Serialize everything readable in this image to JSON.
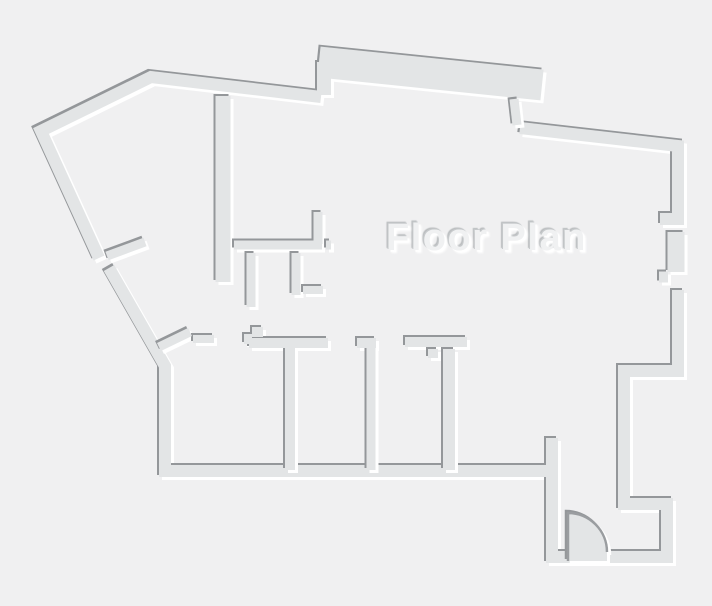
{
  "title": "Floor Plan",
  "colors": {
    "background": "#f0f0f1",
    "wall_fill": "#e3e5e6",
    "edge_dark": "#94979a",
    "edge_highlight": "#ffffff",
    "door_line": "#9a9da0",
    "title_fill": "#f0f1f2"
  },
  "floorplan": {
    "canvas": {
      "width": 712,
      "height": 606
    },
    "exterior": [
      {
        "name": "wall-outline-upper-left",
        "w": 12,
        "points": [
          [
            321,
            97
          ],
          [
            151,
            77
          ],
          [
            41,
            131
          ],
          [
            99,
            258
          ]
        ]
      },
      {
        "name": "wall-outline-lower-left",
        "w": 12,
        "points": [
          [
            109,
            268
          ],
          [
            165,
            366
          ],
          [
            165,
            471
          ],
          [
            548,
            471
          ]
        ]
      },
      {
        "name": "wall-top-protrusion",
        "w": 31,
        "points": [
          [
            319,
            62
          ],
          [
            542,
            85
          ]
        ]
      },
      {
        "name": "wall-protrusion-left-bridge",
        "w": 14,
        "points": [
          [
            324,
            62
          ],
          [
            324,
            95
          ]
        ]
      },
      {
        "name": "wall-top-right",
        "w": 12,
        "points": [
          [
            520,
            128
          ],
          [
            678,
            146
          ],
          [
            678,
            219
          ],
          [
            660,
            219
          ]
        ]
      },
      {
        "name": "wall-right-between-windows",
        "w": 17,
        "points": [
          [
            676,
            232
          ],
          [
            676,
            272
          ]
        ]
      },
      {
        "name": "wall-right-window-jamb",
        "w": 11,
        "points": [
          [
            659,
            277
          ],
          [
            668,
            277
          ]
        ]
      },
      {
        "name": "wall-right-lower-and-entry",
        "w": 12,
        "points": [
          [
            678,
            290
          ],
          [
            678,
            371
          ],
          [
            624,
            371
          ],
          [
            624,
            504
          ],
          [
            667,
            504
          ],
          [
            667,
            557
          ],
          [
            552,
            557
          ],
          [
            552,
            438
          ]
        ]
      }
    ],
    "interior": [
      {
        "name": "wall-hall-vertical",
        "w": 15,
        "points": [
          [
            223,
            96
          ],
          [
            223,
            282
          ]
        ]
      },
      {
        "name": "wall-closet-horizontal",
        "w": 9,
        "points": [
          [
            234,
            245
          ],
          [
            322,
            245
          ]
        ]
      },
      {
        "name": "wall-closet-stub",
        "w": 9,
        "points": [
          [
            318,
            212
          ],
          [
            318,
            244
          ]
        ]
      },
      {
        "name": "wall-closet-nub",
        "w": 9,
        "points": [
          [
            326,
            245
          ],
          [
            331,
            245
          ]
        ]
      },
      {
        "name": "wall-jamb-left",
        "w": 9,
        "points": [
          [
            251,
            253
          ],
          [
            251,
            307
          ]
        ]
      },
      {
        "name": "wall-jamb-mid",
        "w": 9,
        "points": [
          [
            296,
            253
          ],
          [
            296,
            295
          ]
        ]
      },
      {
        "name": "wall-jamb-ell",
        "w": 8,
        "points": [
          [
            303,
            290
          ],
          [
            323,
            290
          ]
        ]
      },
      {
        "name": "wall-diagonal-door-stub",
        "w": 9,
        "points": [
          [
            107,
            256
          ],
          [
            145,
            242
          ]
        ]
      },
      {
        "name": "wall-diagonal-corner-stub",
        "w": 9,
        "points": [
          [
            159,
            347
          ],
          [
            190,
            332
          ]
        ]
      },
      {
        "name": "wall-corner-jamb",
        "w": 8,
        "points": [
          [
            193,
            339
          ],
          [
            214,
            339
          ]
        ]
      },
      {
        "name": "wall-room1-step-a",
        "w": 10,
        "points": [
          [
            244,
            339
          ],
          [
            252,
            339
          ]
        ]
      },
      {
        "name": "wall-room1-step-b",
        "w": 10,
        "points": [
          [
            252,
            332
          ],
          [
            263,
            332
          ]
        ]
      },
      {
        "name": "wall-room1-header",
        "w": 10,
        "points": [
          [
            249,
            343
          ],
          [
            328,
            343
          ]
        ]
      },
      {
        "name": "wall-room-divider-1",
        "w": 10,
        "points": [
          [
            290,
            348
          ],
          [
            290,
            470
          ]
        ]
      },
      {
        "name": "wall-room2-header",
        "w": 10,
        "points": [
          [
            357,
            343
          ],
          [
            376,
            343
          ]
        ]
      },
      {
        "name": "wall-room-divider-2",
        "w": 9,
        "points": [
          [
            371,
            348
          ],
          [
            371,
            470
          ]
        ]
      },
      {
        "name": "wall-room3-header",
        "w": 10,
        "points": [
          [
            405,
            342
          ],
          [
            467,
            342
          ]
        ]
      },
      {
        "name": "wall-room3-step",
        "w": 10,
        "points": [
          [
            433,
            349
          ],
          [
            433,
            358
          ]
        ]
      },
      {
        "name": "wall-room-divider-3",
        "w": 12,
        "points": [
          [
            449,
            349
          ],
          [
            449,
            470
          ]
        ]
      },
      {
        "name": "wall-topright-step",
        "w": 9,
        "points": [
          [
            514,
            99
          ],
          [
            517,
            125
          ]
        ]
      }
    ],
    "door": {
      "cx": 568,
      "cy": 552,
      "r": 39,
      "apron": 9
    }
  }
}
